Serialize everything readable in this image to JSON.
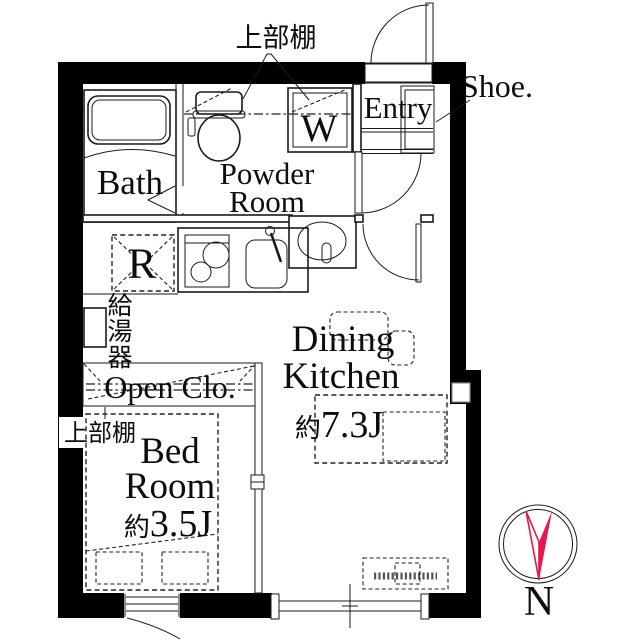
{
  "rooms": {
    "bath": {
      "label": "Bath"
    },
    "powder_room": {
      "lines": [
        "Powder",
        "Room"
      ]
    },
    "entry": {
      "label": "Entry"
    },
    "open_closet": {
      "label": "Open Clo."
    },
    "bedroom": {
      "lines": [
        "Bed",
        "Room"
      ],
      "size_prefix": "約",
      "size_value": "3.5J"
    },
    "dining_kitchen": {
      "lines": [
        "Dining",
        "Kitchen"
      ],
      "size_prefix": "約",
      "size_value": "7.3J"
    }
  },
  "fixtures": {
    "washer_label": "W",
    "refrigerator_label": "R",
    "shoe_label": "Shoe.",
    "water_heater_chars": [
      "給",
      "湯",
      "器"
    ]
  },
  "annotations": {
    "upper_shelf_top": "上部棚",
    "upper_shelf_left": "上部棚"
  },
  "compass": {
    "north_label": "N"
  },
  "colors": {
    "wall": "#000000",
    "line": "#1a1a1a",
    "background": "#ffffff",
    "compass": "#e5174d"
  }
}
